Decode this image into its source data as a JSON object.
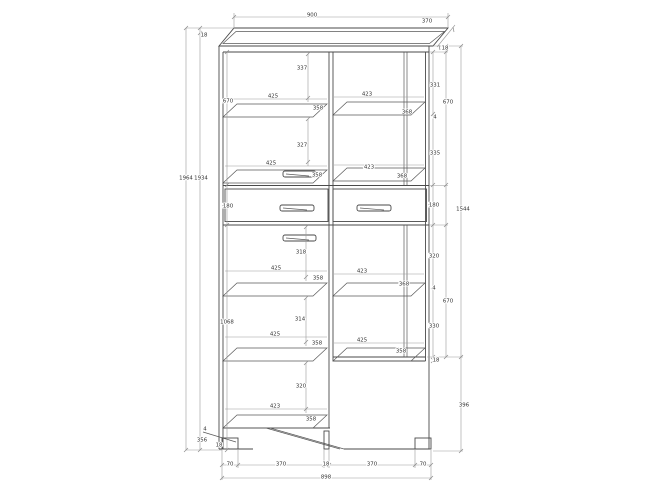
{
  "drawing": {
    "type": "furniture-technical-drawing",
    "subject": "tall two-section display cabinet with two central drawers, front elevation with slight top perspective",
    "colors": {
      "background": "#ffffff",
      "cabinet_line": "#4a4a4a",
      "dimension_line": "#9a9a9a",
      "label_text": "#333333"
    },
    "overall": {
      "width": "900",
      "depth": "370",
      "height_outer": "1964",
      "height_inner": "1934",
      "right_side_height": "1544",
      "top_panel_thickness": "18"
    }
  },
  "dimensions": {
    "labels": [
      {
        "name": "top-width",
        "text": "900",
        "x": 312,
        "y": 15
      },
      {
        "name": "top-depth",
        "text": "370",
        "x": 427,
        "y": 21
      },
      {
        "name": "top-panel-thickness",
        "text": "18",
        "x": 204,
        "y": 35
      },
      {
        "name": "height-outer",
        "text": "1964",
        "x": 186,
        "y": 178
      },
      {
        "name": "height-inner",
        "text": "1934",
        "x": 201,
        "y": 178
      },
      {
        "name": "left-upper-section",
        "text": "670",
        "x": 228,
        "y": 101
      },
      {
        "name": "left-drawer-height",
        "text": "180",
        "x": 228,
        "y": 206
      },
      {
        "name": "left-lower-section",
        "text": "1068",
        "x": 227,
        "y": 322
      },
      {
        "name": "bottom-left-gap",
        "text": "4",
        "x": 205,
        "y": 429
      },
      {
        "name": "bottom-left-depth",
        "text": "356",
        "x": 202,
        "y": 440
      },
      {
        "name": "bottom-left-thickness",
        "text": "18",
        "x": 219,
        "y": 445
      },
      {
        "name": "right-top-thickness",
        "text": "18",
        "x": 445,
        "y": 48
      },
      {
        "name": "right-upper-shelf-gap-1",
        "text": "331",
        "x": 435,
        "y": 85
      },
      {
        "name": "right-upper-shelf-thickness",
        "text": "4",
        "x": 435,
        "y": 117
      },
      {
        "name": "right-upper-shelf-gap-2",
        "text": "335",
        "x": 435,
        "y": 153
      },
      {
        "name": "right-upper-section",
        "text": "670",
        "x": 448,
        "y": 102
      },
      {
        "name": "right-drawer-height",
        "text": "180",
        "x": 434,
        "y": 205
      },
      {
        "name": "right-lower-shelf-gap-1",
        "text": "320",
        "x": 434,
        "y": 256
      },
      {
        "name": "right-lower-shelf-thickness",
        "text": "4",
        "x": 434,
        "y": 288
      },
      {
        "name": "right-lower-shelf-gap-2",
        "text": "330",
        "x": 434,
        "y": 326
      },
      {
        "name": "right-bottom-thickness",
        "text": "18",
        "x": 436,
        "y": 360
      },
      {
        "name": "right-lower-section",
        "text": "670",
        "x": 448,
        "y": 301
      },
      {
        "name": "right-total-upper",
        "text": "1544",
        "x": 463,
        "y": 209
      },
      {
        "name": "right-base-height",
        "text": "396",
        "x": 464,
        "y": 405
      },
      {
        "name": "upper-left-gap-1",
        "text": "337",
        "x": 302,
        "y": 68
      },
      {
        "name": "upper-left-width-1",
        "text": "425",
        "x": 273,
        "y": 96
      },
      {
        "name": "upper-left-depth-1",
        "text": "358",
        "x": 318,
        "y": 108
      },
      {
        "name": "upper-right-width-1",
        "text": "423",
        "x": 367,
        "y": 94
      },
      {
        "name": "upper-right-depth-1",
        "text": "368",
        "x": 407,
        "y": 112
      },
      {
        "name": "upper-left-gap-2",
        "text": "327",
        "x": 302,
        "y": 145
      },
      {
        "name": "upper-left-width-2",
        "text": "425",
        "x": 271,
        "y": 163
      },
      {
        "name": "upper-left-depth-2",
        "text": "358",
        "x": 317,
        "y": 175
      },
      {
        "name": "upper-right-width-2",
        "text": "423",
        "x": 369,
        "y": 167
      },
      {
        "name": "upper-right-depth-2",
        "text": "368",
        "x": 402,
        "y": 176
      },
      {
        "name": "lower-left-gap-1",
        "text": "318",
        "x": 301,
        "y": 252
      },
      {
        "name": "lower-left-width-1",
        "text": "425",
        "x": 276,
        "y": 268
      },
      {
        "name": "lower-left-depth-1",
        "text": "358",
        "x": 318,
        "y": 278
      },
      {
        "name": "lower-right-width-1",
        "text": "423",
        "x": 362,
        "y": 271
      },
      {
        "name": "lower-right-depth-1",
        "text": "368",
        "x": 404,
        "y": 284
      },
      {
        "name": "lower-left-gap-2",
        "text": "314",
        "x": 300,
        "y": 319
      },
      {
        "name": "lower-left-width-2",
        "text": "425",
        "x": 275,
        "y": 334
      },
      {
        "name": "lower-left-depth-2",
        "text": "358",
        "x": 317,
        "y": 343
      },
      {
        "name": "lower-right-width-2",
        "text": "425",
        "x": 362,
        "y": 340
      },
      {
        "name": "lower-right-depth-2",
        "text": "358",
        "x": 401,
        "y": 351
      },
      {
        "name": "lower-left-gap-3",
        "text": "320",
        "x": 301,
        "y": 386
      },
      {
        "name": "lower-left-width-3",
        "text": "423",
        "x": 275,
        "y": 406
      },
      {
        "name": "lower-left-depth-3",
        "text": "358",
        "x": 311,
        "y": 419
      },
      {
        "name": "foot-left-width",
        "text": "70",
        "x": 230,
        "y": 464
      },
      {
        "name": "foot-gap-left",
        "text": "370",
        "x": 281,
        "y": 464
      },
      {
        "name": "center-support-width",
        "text": "18",
        "x": 326,
        "y": 464
      },
      {
        "name": "foot-gap-right",
        "text": "370",
        "x": 372,
        "y": 464
      },
      {
        "name": "foot-right-width",
        "text": "70",
        "x": 423,
        "y": 464
      },
      {
        "name": "bottom-total-width",
        "text": "898",
        "x": 326,
        "y": 477
      }
    ]
  }
}
